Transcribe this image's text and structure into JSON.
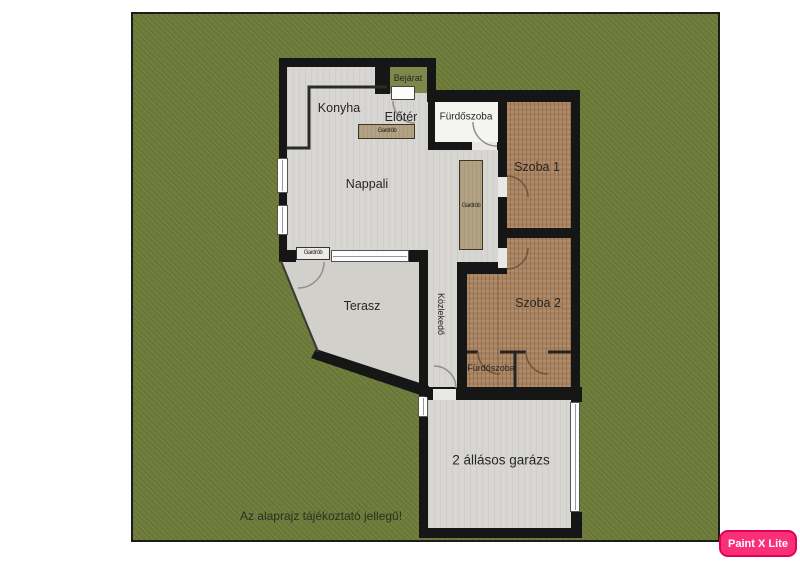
{
  "colors": {
    "grass": "#6f7d3a",
    "wall": "#161616",
    "floor": "#d7d6d2",
    "carpet": "#a8825f",
    "wardrobe": "#b2a182",
    "bath": "#f4f4f1",
    "porch": "#7d894a",
    "badge": "#fb2f77",
    "badge_text": "#ffffff"
  },
  "labels": {
    "bejarat": "Bejárat",
    "konyha": "Konyha",
    "eloter": "Előtér",
    "furdoszoba_top": "Fürdőszoba",
    "szoba1": "Szoba 1",
    "gardrob_eloter": "Gardrób",
    "gardrob_tall": "Gardrób",
    "gardrob_nappali": "Gardrób",
    "nappali": "Nappali",
    "kozlekedo": "Közlekedő",
    "terasz": "Terasz",
    "szoba2": "Szoba 2",
    "furdoszoba_bottom": "Fürdőszoba",
    "garazs": "2 állásos garázs",
    "disclaimer": "Az alaprajz tájékoztató jellegű!",
    "watermark": "Paint X Lite"
  }
}
